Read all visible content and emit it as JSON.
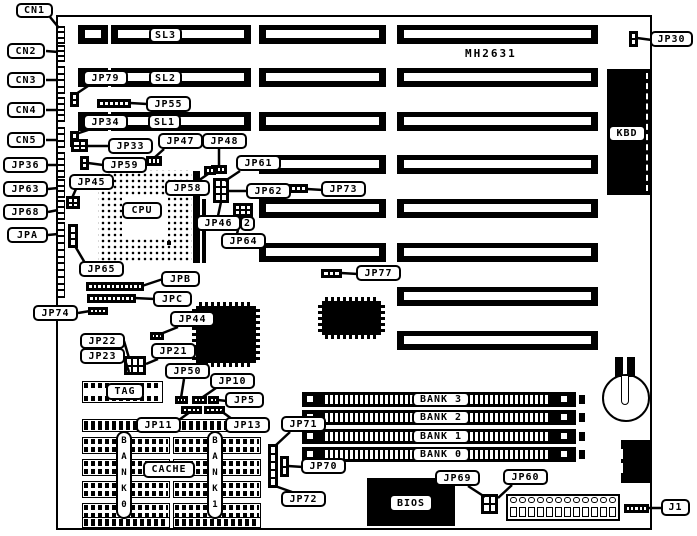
{
  "title": "MH2631 motherboard jumper location diagram",
  "board_marking": "MH2631",
  "colors": {
    "ink": "#000000",
    "paper": "#ffffff"
  },
  "callouts": {
    "cn1": "CN1",
    "cn2": "CN2",
    "cn3": "CN3",
    "cn4": "CN4",
    "cn5": "CN5",
    "jp36": "JP36",
    "jp63": "JP63",
    "jp68": "JP68",
    "jpa": "JPA",
    "jp74": "JP74",
    "jp79": "JP79",
    "jp55": "JP55",
    "jp34": "JP34",
    "jp33": "JP33",
    "jp59": "JP59",
    "jp45": "JP45",
    "jp65": "JP65",
    "sl3": "SL3",
    "sl2": "SL2",
    "sl1": "SL1",
    "jp47": "JP47",
    "jp48": "JP48",
    "jp61": "JP61",
    "jp62": "JP62",
    "jp46": "JP46",
    "jp64": "JP64",
    "pin2": "2",
    "jp73": "JP73",
    "jp58": "JP58",
    "jp77": "JP77",
    "jpb": "JPB",
    "jpc": "JPC",
    "jp44": "JP44",
    "jp22": "JP22",
    "jp23": "JP23",
    "jp21": "JP21",
    "jp50": "JP50",
    "jp10": "JP10",
    "jp5": "JP5",
    "tag": "TAG",
    "jp11": "JP11",
    "jp13": "JP13",
    "cache": "CACHE",
    "jp71": "JP71",
    "jp70": "JP70",
    "jp72": "JP72",
    "jp69": "JP69",
    "jp60": "JP60",
    "j1": "J1",
    "jp30": "JP30",
    "kbd": "KBD",
    "cpu": "CPU",
    "bios": "BIOS"
  },
  "simm_bank_labels": [
    "BANK 3",
    "BANK 2",
    "BANK 1",
    "BANK 0"
  ],
  "cache_bank_labels": [
    "BANK0",
    "BANK1"
  ]
}
